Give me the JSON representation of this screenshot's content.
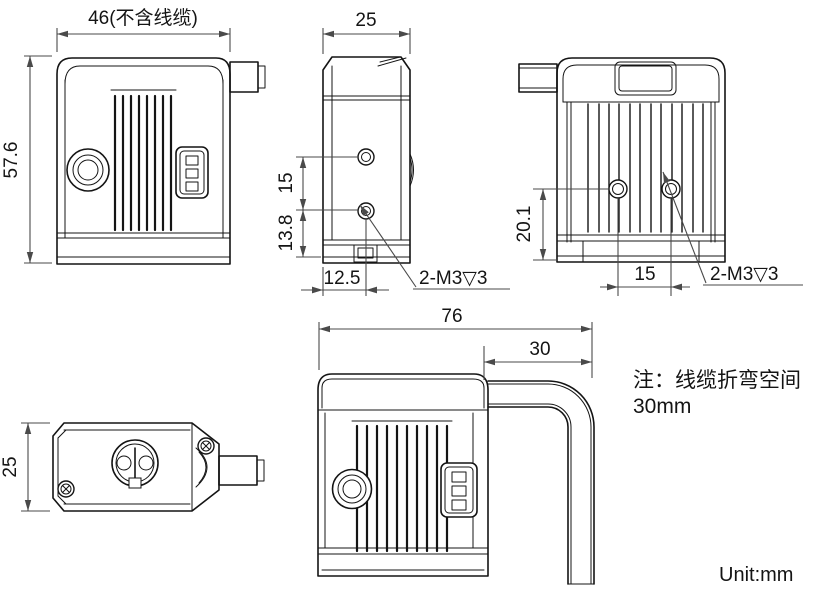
{
  "colors": {
    "background": "#ffffff",
    "line": "#141414",
    "dimension": "#4a4a4a"
  },
  "unit_label": "Unit:mm",
  "note": {
    "line1": "注：线缆折弯空间",
    "line2": "30mm"
  },
  "views": {
    "front": {
      "width": "46(不含线缆)",
      "height": "57.6"
    },
    "side": {
      "width": "25",
      "hole_spacing": "15",
      "hole_to_base": "13.8",
      "hole_offset": "12.5",
      "thread": "2-M3▽3"
    },
    "back": {
      "hole_height": "20.1",
      "hole_spacing": "15",
      "thread": "2-M3▽3"
    },
    "top": {
      "depth": "25"
    },
    "front_cable": {
      "total_width": "76",
      "cable_clearance": "30"
    }
  }
}
